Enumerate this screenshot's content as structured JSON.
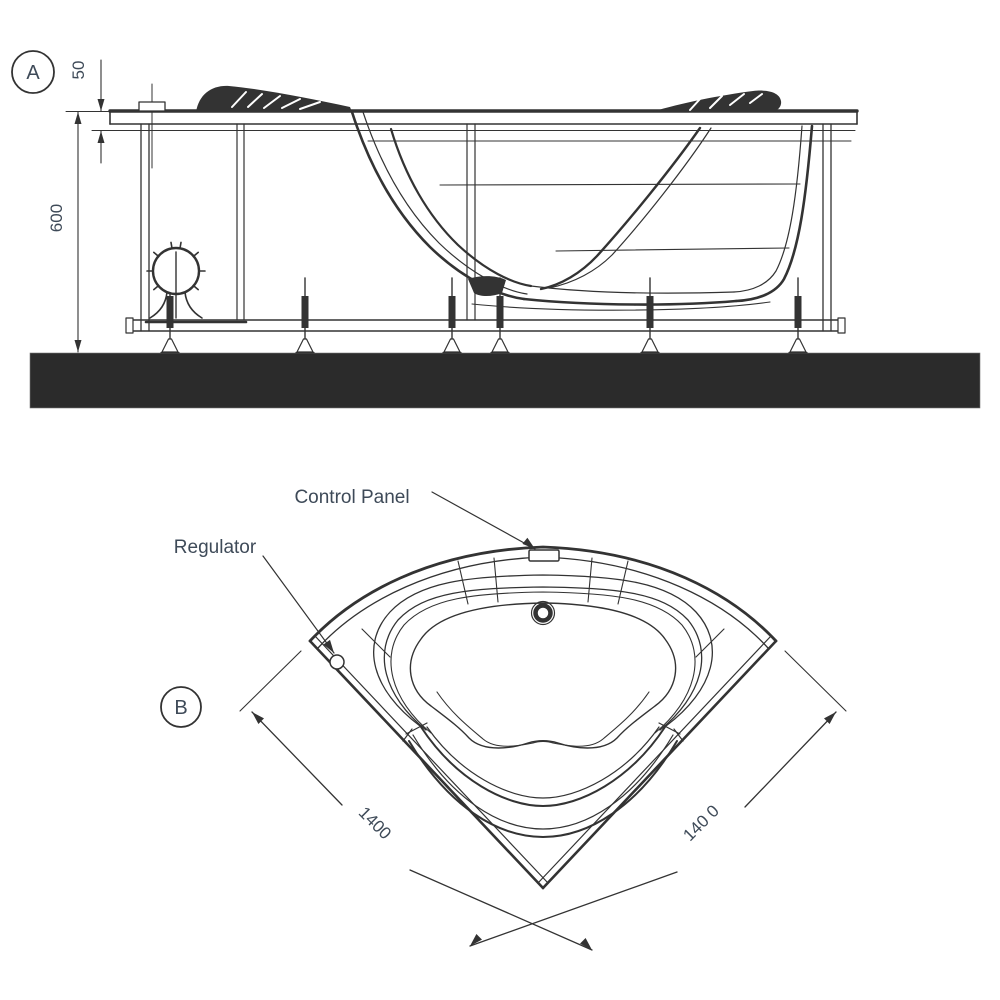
{
  "colors": {
    "line": "#333333",
    "text": "#3e4a58",
    "floor": "#2b2b2b",
    "background": "#ffffff"
  },
  "view_a": {
    "badge": "A",
    "height_dim": "600",
    "rim_dim": "50"
  },
  "view_b": {
    "badge": "B",
    "left_dim": "1400",
    "right_dim": "140 0",
    "control_panel_label": "Control Panel",
    "regulator_label": "Regulator"
  }
}
